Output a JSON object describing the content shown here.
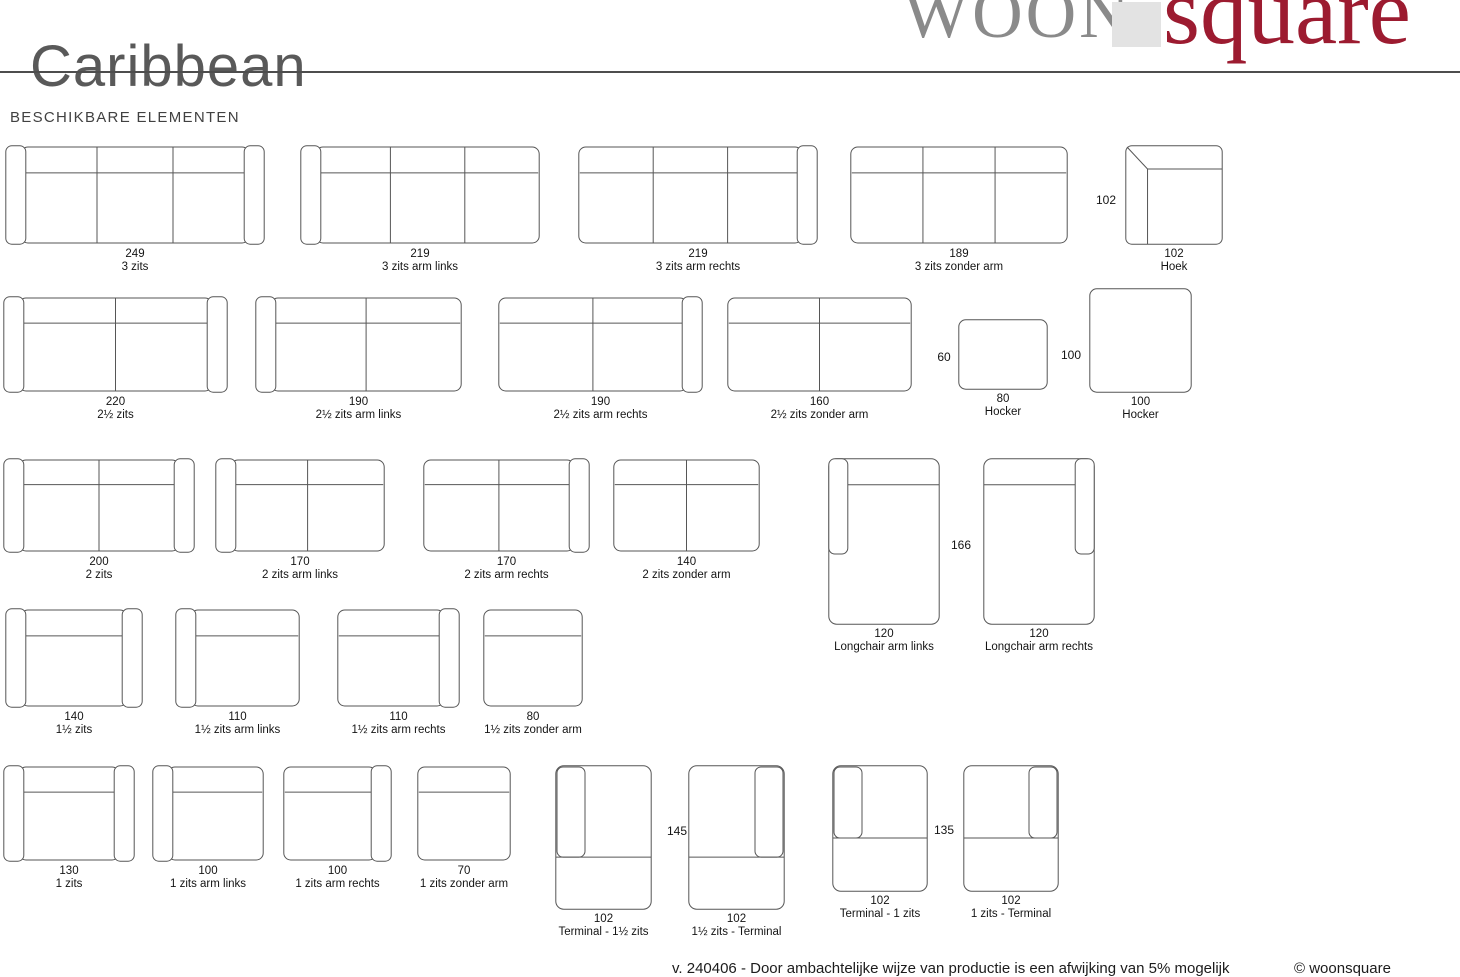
{
  "page": {
    "title": "Caribbean",
    "section_heading": "BESCHIKBARE ELEMENTEN",
    "footer": {
      "disclaimer": "v. 240406 - Door ambachtelijke wijze van productie is een afwijking van 5% mogelijk",
      "copyright": "© woonsquare"
    }
  },
  "logo": {
    "part1": "WOON",
    "part2": "square"
  },
  "colors": {
    "line": "#565656",
    "label": "#141414",
    "title_gray": "#595959",
    "logo_gray": "#8a8a8a",
    "logo_red": "#9c1b30",
    "logo_block": "#e3e3e3",
    "rule": "#4d4d4d"
  },
  "elements": [
    {
      "size": "249",
      "name": "3 zits",
      "kind": "sofa",
      "seats": 3,
      "arm_left": true,
      "arm_right": true,
      "x": 5,
      "y": 145,
      "w": 260,
      "h": 100
    },
    {
      "size": "219",
      "name": "3 zits arm links",
      "kind": "sofa",
      "seats": 3,
      "arm_left": true,
      "arm_right": false,
      "x": 300,
      "y": 145,
      "w": 240,
      "h": 100
    },
    {
      "size": "219",
      "name": "3 zits arm rechts",
      "kind": "sofa",
      "seats": 3,
      "arm_left": false,
      "arm_right": true,
      "x": 578,
      "y": 145,
      "w": 240,
      "h": 100
    },
    {
      "size": "189",
      "name": "3 zits zonder arm",
      "kind": "sofa",
      "seats": 3,
      "arm_left": false,
      "arm_right": false,
      "x": 850,
      "y": 145,
      "w": 218,
      "h": 100
    },
    {
      "size": "102",
      "name": "Hoek",
      "kind": "corner",
      "x": 1125,
      "y": 145,
      "w": 98,
      "h": 100
    },
    {
      "size": "220",
      "name": "2½ zits",
      "kind": "sofa",
      "seats": 2,
      "arm_left": true,
      "arm_right": true,
      "x": 3,
      "y": 296,
      "w": 225,
      "h": 97
    },
    {
      "size": "190",
      "name": "2½ zits arm links",
      "kind": "sofa",
      "seats": 2,
      "arm_left": true,
      "arm_right": false,
      "x": 255,
      "y": 296,
      "w": 207,
      "h": 97
    },
    {
      "size": "190",
      "name": "2½ zits arm rechts",
      "kind": "sofa",
      "seats": 2,
      "arm_left": false,
      "arm_right": true,
      "x": 498,
      "y": 296,
      "w": 205,
      "h": 97
    },
    {
      "size": "160",
      "name": "2½ zits zonder arm",
      "kind": "sofa",
      "seats": 2,
      "arm_left": false,
      "arm_right": false,
      "x": 727,
      "y": 296,
      "w": 185,
      "h": 97
    },
    {
      "size": "80",
      "name": "Hocker",
      "kind": "hocker",
      "x": 958,
      "y": 319,
      "w": 90,
      "h": 71
    },
    {
      "size": "100",
      "name": "Hocker",
      "kind": "hocker",
      "x": 1089,
      "y": 288,
      "w": 103,
      "h": 105
    },
    {
      "size": "200",
      "name": "2 zits",
      "kind": "sofa",
      "seats": 2,
      "arm_left": true,
      "arm_right": true,
      "x": 3,
      "y": 458,
      "w": 192,
      "h": 95
    },
    {
      "size": "170",
      "name": "2 zits arm links",
      "kind": "sofa",
      "seats": 2,
      "arm_left": true,
      "arm_right": false,
      "x": 215,
      "y": 458,
      "w": 170,
      "h": 95
    },
    {
      "size": "170",
      "name": "2 zits arm rechts",
      "kind": "sofa",
      "seats": 2,
      "arm_left": false,
      "arm_right": true,
      "x": 423,
      "y": 458,
      "w": 167,
      "h": 95
    },
    {
      "size": "140",
      "name": "2 zits zonder arm",
      "kind": "sofa",
      "seats": 2,
      "arm_left": false,
      "arm_right": false,
      "x": 613,
      "y": 458,
      "w": 147,
      "h": 95
    },
    {
      "size": "120",
      "name": "Longchair arm links",
      "kind": "longchair",
      "arm": "left",
      "x": 828,
      "y": 458,
      "w": 112,
      "h": 167
    },
    {
      "size": "120",
      "name": "Longchair arm rechts",
      "kind": "longchair",
      "arm": "right",
      "x": 983,
      "y": 458,
      "w": 112,
      "h": 167
    },
    {
      "size": "140",
      "name": "1½ zits",
      "kind": "sofa",
      "seats": 1,
      "arm_left": true,
      "arm_right": true,
      "x": 5,
      "y": 608,
      "w": 138,
      "h": 100
    },
    {
      "size": "110",
      "name": "1½ zits arm links",
      "kind": "sofa",
      "seats": 1,
      "arm_left": true,
      "arm_right": false,
      "x": 175,
      "y": 608,
      "w": 125,
      "h": 100
    },
    {
      "size": "110",
      "name": "1½ zits arm rechts",
      "kind": "sofa",
      "seats": 1,
      "arm_left": false,
      "arm_right": true,
      "x": 337,
      "y": 608,
      "w": 123,
      "h": 100
    },
    {
      "size": "80",
      "name": "1½ zits zonder arm",
      "kind": "sofa",
      "seats": 1,
      "arm_left": false,
      "arm_right": false,
      "x": 483,
      "y": 608,
      "w": 100,
      "h": 100
    },
    {
      "size": "130",
      "name": "1 zits",
      "kind": "sofa",
      "seats": 1,
      "arm_left": true,
      "arm_right": true,
      "x": 3,
      "y": 765,
      "w": 132,
      "h": 97
    },
    {
      "size": "100",
      "name": "1 zits arm links",
      "kind": "sofa",
      "seats": 1,
      "arm_left": true,
      "arm_right": false,
      "x": 152,
      "y": 765,
      "w": 112,
      "h": 97
    },
    {
      "size": "100",
      "name": "1 zits arm rechts",
      "kind": "sofa",
      "seats": 1,
      "arm_left": false,
      "arm_right": true,
      "x": 283,
      "y": 765,
      "w": 109,
      "h": 97
    },
    {
      "size": "70",
      "name": "1 zits zonder arm",
      "kind": "sofa",
      "seats": 1,
      "arm_left": false,
      "arm_right": false,
      "x": 417,
      "y": 765,
      "w": 94,
      "h": 97
    },
    {
      "size": "102",
      "name": "Terminal - 1½ zits",
      "kind": "terminal",
      "arm": "left",
      "seat_ratio": 0.635,
      "x": 555,
      "y": 765,
      "w": 97,
      "h": 145
    },
    {
      "size": "102",
      "name": "1½ zits - Terminal",
      "kind": "terminal",
      "arm": "right",
      "seat_ratio": 0.635,
      "x": 688,
      "y": 765,
      "w": 97,
      "h": 145
    },
    {
      "size": "102",
      "name": "Terminal - 1 zits",
      "kind": "terminal",
      "arm": "left",
      "seat_ratio": 0.575,
      "x": 832,
      "y": 765,
      "w": 96,
      "h": 127
    },
    {
      "size": "102",
      "name": "1 zits - Terminal",
      "kind": "terminal",
      "arm": "right",
      "seat_ratio": 0.575,
      "x": 963,
      "y": 765,
      "w": 96,
      "h": 127
    }
  ],
  "dimension_labels": [
    {
      "text": "102",
      "x": 1106,
      "y": 200
    },
    {
      "text": "60",
      "x": 944,
      "y": 357
    },
    {
      "text": "100",
      "x": 1071,
      "y": 355
    },
    {
      "text": "166",
      "x": 961,
      "y": 545
    },
    {
      "text": "145",
      "x": 677,
      "y": 831
    },
    {
      "text": "135",
      "x": 944,
      "y": 830
    }
  ]
}
